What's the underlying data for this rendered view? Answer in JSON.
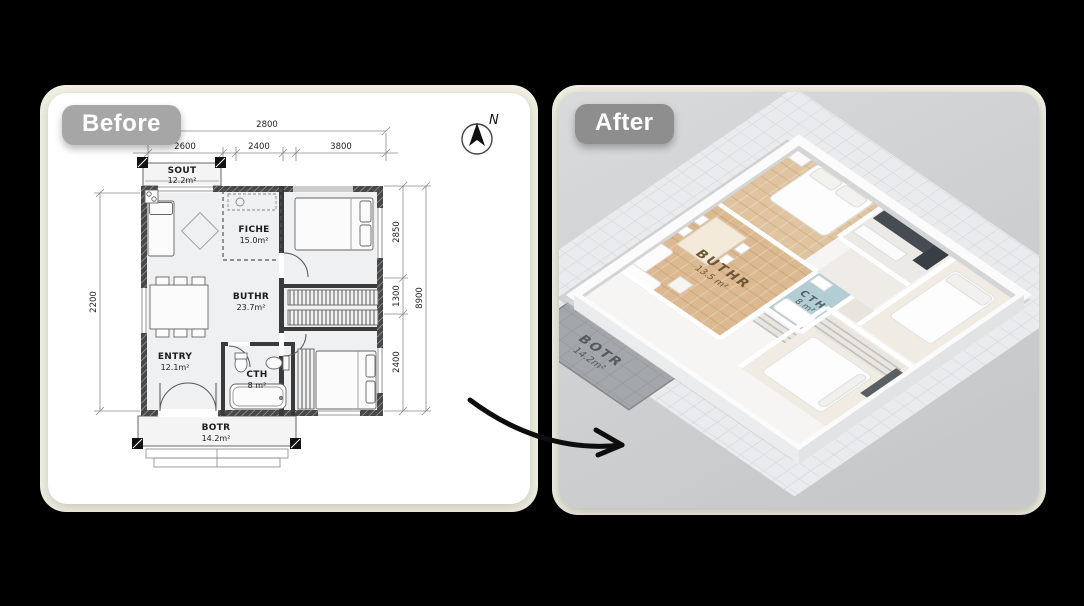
{
  "before": {
    "badge": "Before",
    "compass_label": "N",
    "dims": {
      "top_total": "2800",
      "top_seg_1": "2600",
      "top_seg_2": "2400",
      "top_seg_3": "3800",
      "left_height": "2200",
      "right_seg_1": "2850",
      "right_seg_2": "1300",
      "right_seg_3": "2400",
      "right_total": "8900"
    },
    "rooms": {
      "sout": {
        "name": "SOUT",
        "area": "12.2m²"
      },
      "fiche": {
        "name": "FICHE",
        "area": "15.0m²"
      },
      "buthr": {
        "name": "BUTHR",
        "area": "23.7m²"
      },
      "entry": {
        "name": "ENTRY",
        "area": "12.1m²"
      },
      "cth": {
        "name": "CTH",
        "area": "8 m²"
      },
      "botr": {
        "name": "BOTR",
        "area": "14.2m²"
      }
    }
  },
  "after": {
    "badge": "After",
    "rooms": {
      "buthr": {
        "name": "BUTHR",
        "area": "13.5 m²"
      },
      "cth": {
        "name": "CTH",
        "area": "8 m²"
      },
      "botr": {
        "name": "BOTR",
        "area": "14.2m²"
      }
    }
  },
  "colors": {
    "canvas": "#000000",
    "page_frame": "#f3f1e3",
    "before_card": "#ffffff",
    "after_card": "#cfd0d2",
    "badge_before": "#a6a6a6",
    "badge_after": "#8e8e8e",
    "wood_floor": "#dcb990",
    "bath_tile": "#b2cdd3",
    "terrace": "#a3a7ab",
    "kitchen_counter": "#474c52"
  }
}
